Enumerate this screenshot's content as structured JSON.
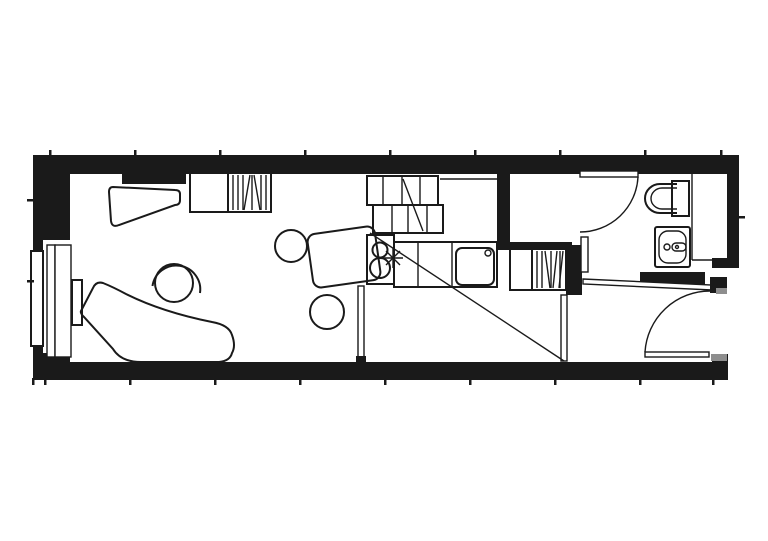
{
  "document": {
    "type": "architectural-floor-plan",
    "subject": "narrow studio apartment: living area with chaise and round table, kitchen under stair, wardrobes, bathroom with toilet and washbasin, entry door",
    "visible_text": ""
  },
  "canvas": {
    "width": 768,
    "height": 541,
    "background": "#ffffff"
  },
  "colors": {
    "wall_fill": "#1a1a1a",
    "line": "#1a1a1a",
    "door_frame": "#8e8e8e",
    "surface": "#ffffff"
  },
  "fixtures": {
    "living": [
      "window",
      "window-bench",
      "desk",
      "wardrobe",
      "wardrobe-hatched",
      "round-table",
      "chaise-longue"
    ],
    "kitchen": [
      "dining-table",
      "stool",
      "stool",
      "cooktop-unit",
      "burner",
      "burner",
      "faucet-symbol",
      "counter",
      "sink-basin",
      "drain"
    ],
    "stairs": [
      "upper-run",
      "lower-run",
      "direction-line"
    ],
    "bathroom": [
      "door-leaf",
      "door-swing-arc",
      "toilet",
      "washbasin",
      "pipe-space"
    ],
    "entry": [
      "entrance-door-leaf",
      "entrance-swing-arc",
      "door-jambs",
      "sliding-partition"
    ],
    "annotations": [
      "survey-tick-marks",
      "long-diagonal-line"
    ]
  }
}
